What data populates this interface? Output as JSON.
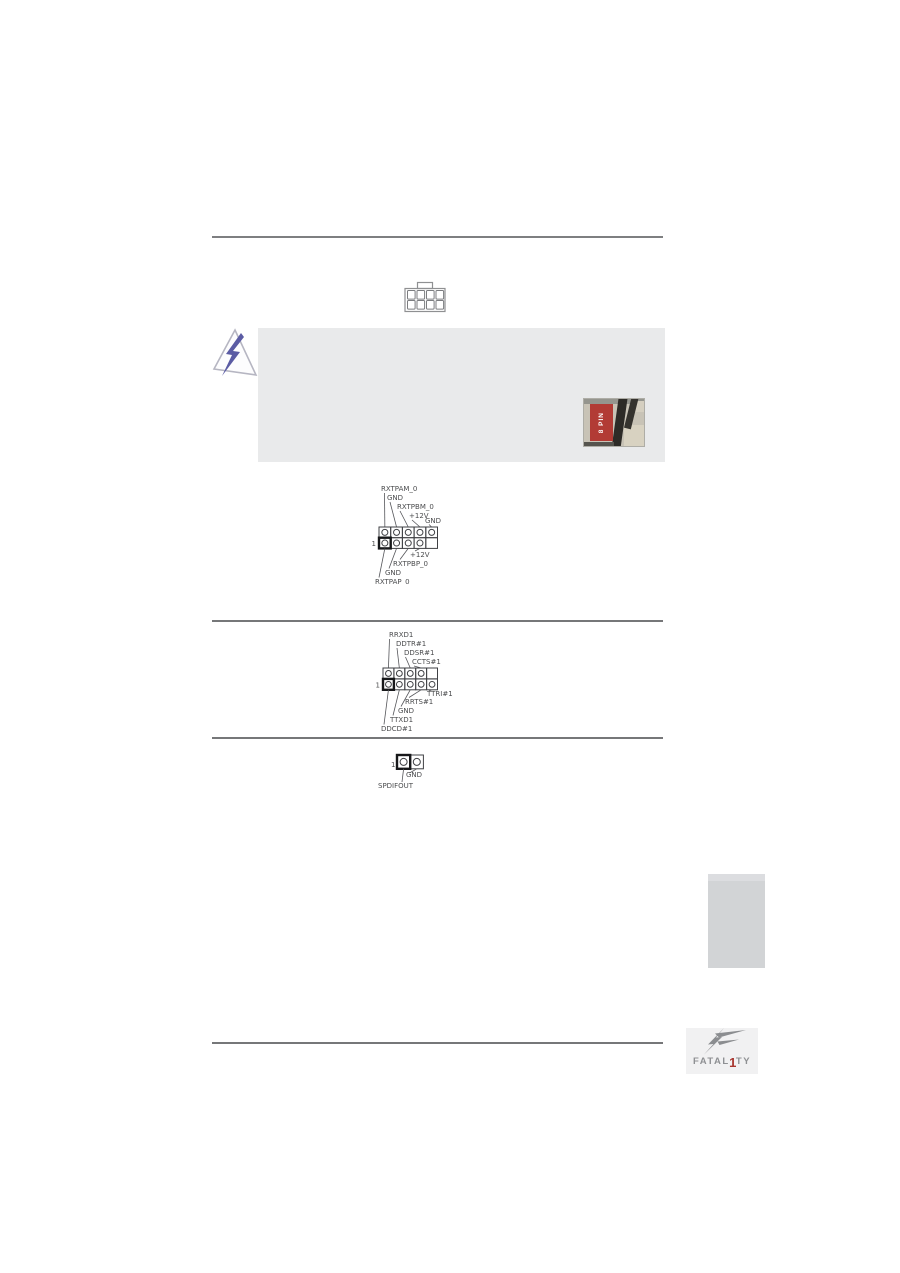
{
  "page": {
    "width": 900,
    "height": 1273,
    "background": "#ffffff"
  },
  "colors": {
    "rule_gray": "#767779",
    "diagram_ink": "#3f4044",
    "label_ink": "#4b4c4e",
    "warning_box_bg": "#e9eaeb",
    "warning_bolt_blue": "#5b5ca4",
    "side_tab_gray": "#d2d4d6",
    "photo_label_red": "#b23b35",
    "logo_gray": "#8e9093",
    "logo_red": "#a8362f"
  },
  "icons": {
    "power_connector": "atx-8pin-outline",
    "warning": "lightning-bolt-in-triangle",
    "brand_mark": "fatal1ty-lightning-f"
  },
  "warning": {
    "photo_label": "8 PIN"
  },
  "diagrams": {
    "power": {
      "pin1": "1",
      "top_labels": [
        "RXTPAM_0",
        "GND",
        "RXTPBM_0",
        "+12V",
        "GND"
      ],
      "bottom_labels": [
        "+12V",
        "RXTPBP_0",
        "GND",
        "RXTPAP_0"
      ]
    },
    "com": {
      "pin1": "1",
      "top_labels": [
        "RRXD1",
        "DDTR#1",
        "DDSR#1",
        "CCTS#1"
      ],
      "bottom_labels": [
        "TTRI#1",
        "RRTS#1",
        "GND",
        "TTXD1",
        "DDCD#1"
      ]
    },
    "spdif": {
      "pin1": "1",
      "gnd_label": "GND",
      "out_label": "SPDIFOUT"
    }
  },
  "footer": {
    "logo_text_pre": "FATAL",
    "logo_text_one": "1",
    "logo_text_post": "TY"
  }
}
